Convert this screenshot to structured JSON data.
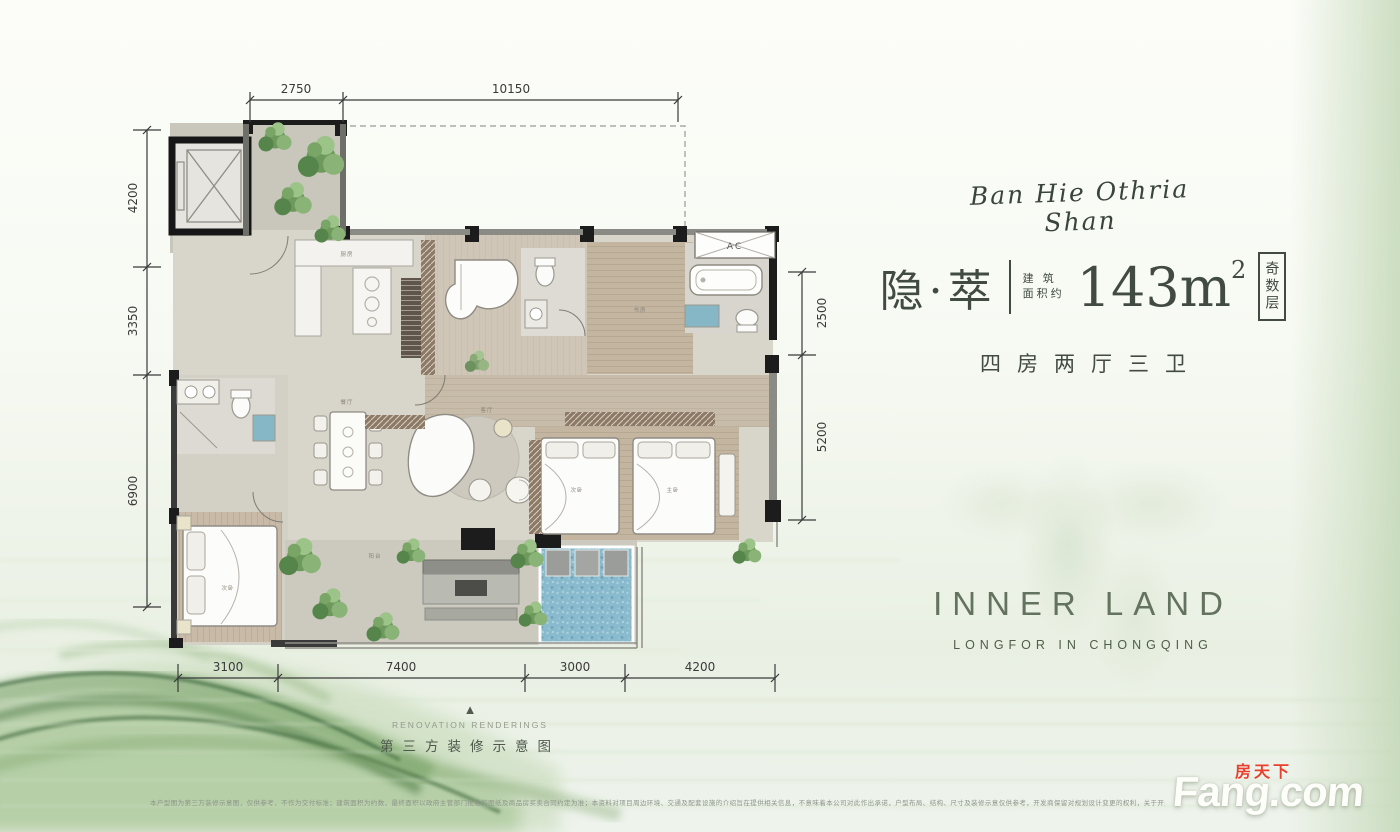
{
  "title_block": {
    "signature": "Ban Hie Othria Shan",
    "name": "隐·萃",
    "area_label_line1": "建 筑",
    "area_label_line2": "面积约",
    "area_value": "143m",
    "area_sup": "2",
    "floor_tag": "奇数层",
    "layout": "四房两厅三卫"
  },
  "brand": {
    "logo": "INNER LAND",
    "subtitle": "LONGFOR IN CHONGQING"
  },
  "footer": {
    "marker": "▲",
    "en": "RENOVATION RENDERINGS",
    "cn": "第三方装修示意图",
    "disclaimer": "本户型图为第三方装修示意图，仅供参考，不作为交付标准；建筑面积为约数，最终面积以政府主管部门批准的图纸及商品房买卖合同约定为准；本资料对项目周边环境、交通及配套设施的介绍旨在提供相关信息，不意味着本公司对此作出承诺，户型布局、结构、尺寸及装修示意仅供参考，开发商保留对规划设计变更的权利，关于开盘时间装修、交房要求及详细信息以及最终解释权以政府批文及双方签订的合同为准。"
  },
  "watermark": {
    "cn": "房天下",
    "en": "Fang.com"
  },
  "plan": {
    "dims": {
      "top": [
        "2750",
        "10150"
      ],
      "left": [
        "4200",
        "3350",
        "6900"
      ],
      "right": [
        "2500",
        "5200"
      ],
      "bottom": [
        "3100",
        "7400",
        "3000",
        "4200"
      ]
    },
    "rooms": {
      "kitchen": "厨房",
      "dining": "餐厅",
      "living": "客厅",
      "study": "书房",
      "master": "主卧",
      "bedroom2": "次卧",
      "bedroom3": "次卧",
      "balcony": "阳台",
      "ac": "AC"
    }
  }
}
